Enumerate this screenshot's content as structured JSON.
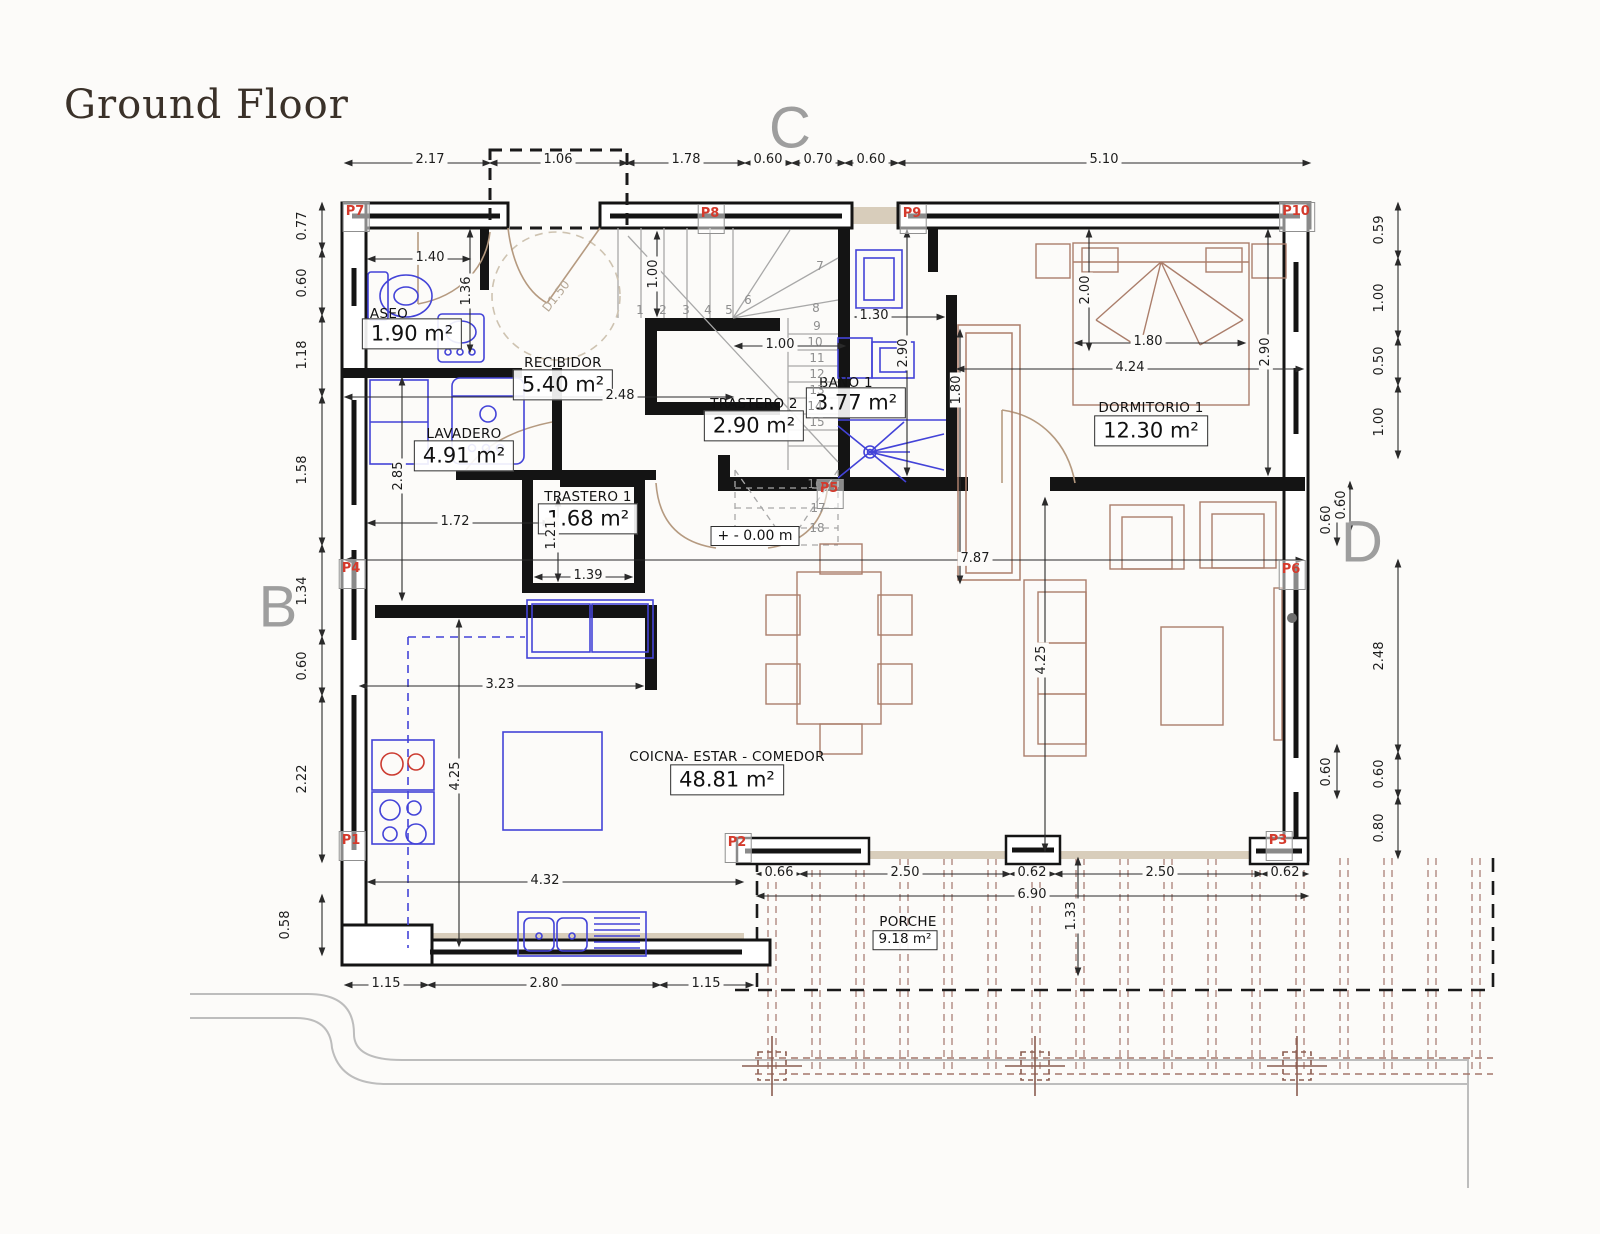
{
  "title": "Ground Floor",
  "letters": {
    "b": "B",
    "c": "C",
    "d": "D"
  },
  "rooms": [
    {
      "name": "ASEO",
      "area": "1.90 m²"
    },
    {
      "name": "RECIBIDOR",
      "area": "5.40 m²"
    },
    {
      "name": "LAVADERO",
      "area": "4.91 m²"
    },
    {
      "name": "TRASTERO 2",
      "area": "2.90 m²"
    },
    {
      "name": "BAÑO 1",
      "area": "3.77 m²"
    },
    {
      "name": "TRASTERO 1",
      "area": "1.68 m²"
    },
    {
      "name": "DORMITORIO 1",
      "area": "12.30 m²"
    },
    {
      "name": "COICNA- ESTAR - COMEDOR",
      "area": "48.81 m²"
    },
    {
      "name": "PORCHE",
      "area": "9.18 m²"
    }
  ],
  "level_marker": "+ - 0.00 m",
  "door_circle": "D1.50",
  "p_labels": [
    "P1",
    "P2",
    "P3",
    "P4",
    "P5",
    "P6",
    "P7",
    "P8",
    "P9",
    "P10"
  ],
  "stairs": [
    "1",
    "2",
    "3",
    "4",
    "5",
    "6",
    "7",
    "8",
    "9",
    "10",
    "11",
    "12",
    "13",
    "14",
    "15",
    "16",
    "17",
    "18"
  ],
  "dims": {
    "top": [
      "2.17",
      "1.06",
      "1.78",
      "0.60",
      "0.70",
      "0.60",
      "5.10"
    ],
    "left": [
      "0.77",
      "0.60",
      "1.18",
      "1.58",
      "1.34",
      "0.60",
      "2.22",
      "0.58"
    ],
    "right_outer": [
      "0.59",
      "1.00",
      "0.50",
      "1.00",
      "0.60",
      "2.48",
      "0.60",
      "0.80"
    ],
    "right_inner": [
      "0.60",
      "0.60"
    ],
    "bottom": [
      "1.15",
      "2.80",
      "1.15"
    ],
    "porch": [
      "0.66",
      "2.50",
      "0.62",
      "2.50",
      "0.62",
      "6.90",
      "1.33"
    ],
    "interior": [
      "1.40",
      "1.36",
      "1.00",
      "1.00",
      "2.48",
      "1.30",
      "2.90",
      "1.80",
      "2.00",
      "1.80",
      "4.24",
      "2.90",
      "2.85",
      "1.72",
      "1.21",
      "1.39",
      "3.23",
      "4.25",
      "4.32",
      "7.87",
      "4.25"
    ]
  }
}
